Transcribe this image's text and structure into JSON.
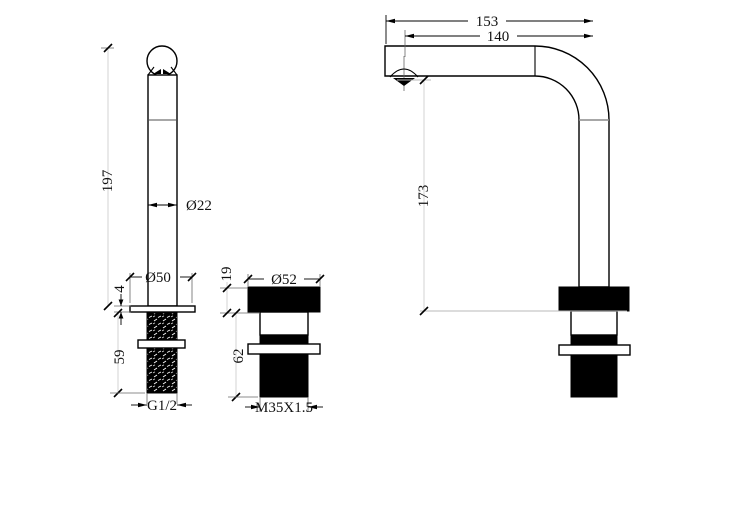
{
  "colors": {
    "background": "#ffffff",
    "line": "#000000",
    "seam_line": "#8a8a8a",
    "dim_line_light": "#c9c9c9"
  },
  "views": {
    "spout_body": {
      "height": "197",
      "body_diameter": "Ø22",
      "flange_diameter": "Ø50",
      "flange_thickness": "4",
      "shank_length": "59",
      "thread": "G1/2"
    },
    "mount_base": {
      "cap_height": "19",
      "cap_diameter": "Ø52",
      "below_counter_height": "62",
      "thread": "M35X1.5"
    },
    "spout_profile": {
      "overall_reach": "153",
      "outlet_reach": "140",
      "outlet_height": "173"
    }
  }
}
